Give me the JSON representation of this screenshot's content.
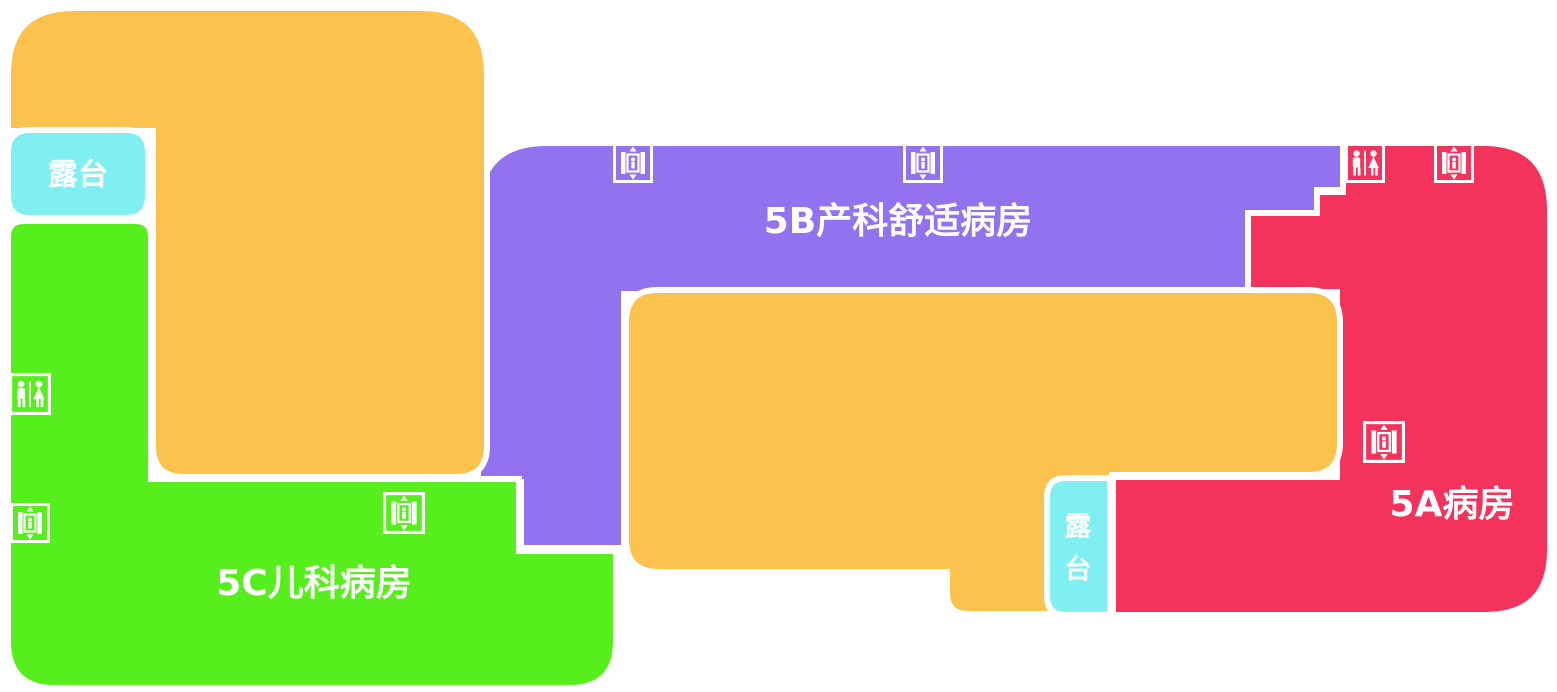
{
  "map_title": "hospital-floor-plan-level-5",
  "colors": {
    "background": "#ffffff",
    "border": "#ffffff",
    "orange": "#FCC24E",
    "purple": "#9372F0",
    "pink": "#F4335C",
    "green": "#56EF1D",
    "cyan": "#80EFF2"
  },
  "regions": {
    "ward_5b": {
      "label": "5B产科舒适病房",
      "color": "#9372F0"
    },
    "ward_5a": {
      "label": "5A病房",
      "color": "#F4335C"
    },
    "ward_5c": {
      "label": "5C儿科病房",
      "color": "#56EF1D"
    },
    "terrace_upper": {
      "label": "露台",
      "color": "#80EFF2"
    },
    "terrace_lower": {
      "label": "露台",
      "lines": [
        "露",
        "台"
      ],
      "color": "#80EFF2"
    },
    "block_upper": {
      "color": "#FCC24E"
    },
    "block_central": {
      "color": "#FCC24E"
    }
  },
  "icons": [
    {
      "type": "elevator",
      "x": 613,
      "y": 143,
      "size": 40
    },
    {
      "type": "elevator",
      "x": 903,
      "y": 143,
      "size": 40
    },
    {
      "type": "restroom",
      "x": 1345,
      "y": 143,
      "size": 40
    },
    {
      "type": "elevator",
      "x": 1434,
      "y": 143,
      "size": 40
    },
    {
      "type": "elevator",
      "x": 1363,
      "y": 421,
      "size": 42
    },
    {
      "type": "restroom",
      "x": 9,
      "y": 373,
      "size": 42
    },
    {
      "type": "elevator",
      "x": 10,
      "y": 503,
      "size": 40
    },
    {
      "type": "elevator",
      "x": 383,
      "y": 492,
      "size": 42
    }
  ]
}
